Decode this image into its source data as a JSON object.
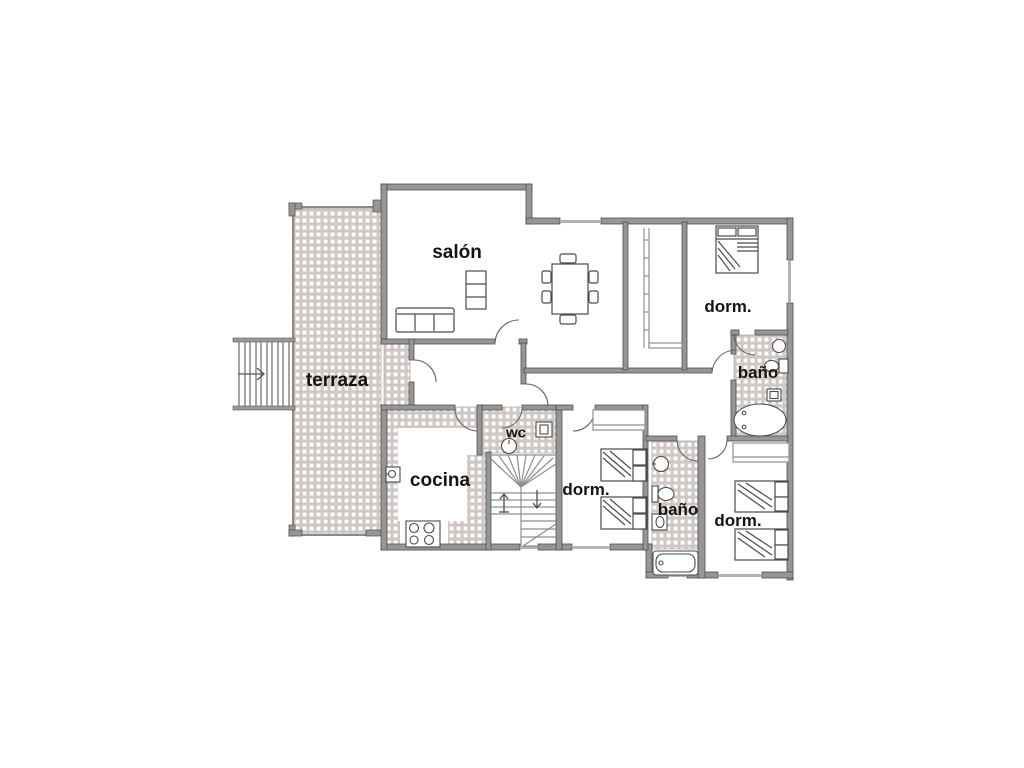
{
  "figure": {
    "kind": "architectural floor plan",
    "language": "Spanish",
    "description": "Single-storey apartment floor plan with tiled terrace, living room, kitchen, three bedrooms, two bathrooms and a WC"
  },
  "rooms": {
    "salon": {
      "label": "salón"
    },
    "terraza": {
      "label": "terraza"
    },
    "cocina": {
      "label": "cocina"
    },
    "wc": {
      "label": "wc"
    },
    "dorm_top": {
      "label": "dorm."
    },
    "bano_top": {
      "label": "baño"
    },
    "dorm_mid": {
      "label": "dorm."
    },
    "bano_bottom": {
      "label": "baño"
    },
    "dorm_bottom": {
      "label": "dorm."
    }
  },
  "colors": {
    "background": "#ffffff",
    "wall_gray": "#969696",
    "wall_edge": "#4f4f4f",
    "tile_grout": "#cfc7c3",
    "furniture_line": "#4a4a4a",
    "label_text": "#141414"
  }
}
